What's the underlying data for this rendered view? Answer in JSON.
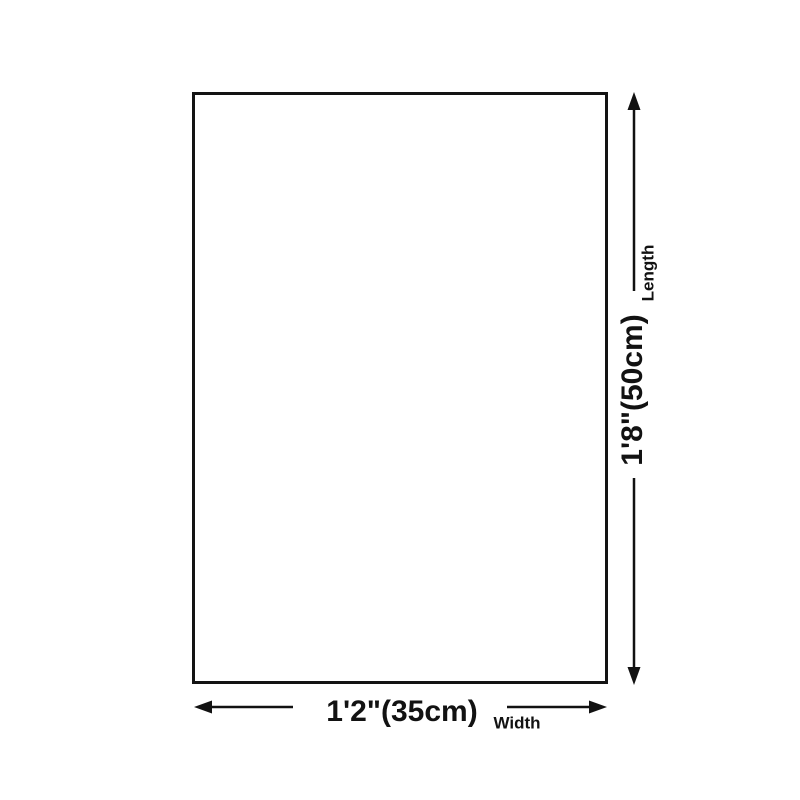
{
  "diagram": {
    "length": {
      "value": "1'8\"(50cm)",
      "label": "Length"
    },
    "width": {
      "value": "1'2\"(35cm)",
      "label": "Width"
    },
    "colors": {
      "line": "#121212",
      "background": "#ffffff"
    }
  }
}
